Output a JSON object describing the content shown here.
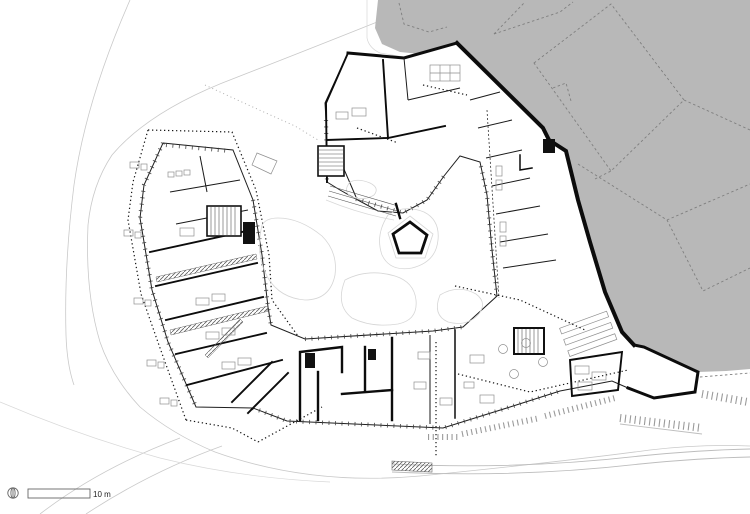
{
  "document": {
    "type": "architectural ground floor plan",
    "description": "Polygonal building complex around a central courtyard with pentagon planter; shaded adjacent site with dashed neighbouring-building outlines at upper right; site contour lines; scale bar lower left"
  },
  "scale_bar": {
    "label": "10 m"
  },
  "icons": {
    "north_indicator": "north-compass-icon"
  },
  "colors": {
    "background": "#ffffff",
    "adjacent_area": "#b8b8b8",
    "wall": "#0c0c0c",
    "contour": "#c9c9c9",
    "dashed_neighbor": "#7f7f7f",
    "furniture": "#8f8f8f"
  }
}
